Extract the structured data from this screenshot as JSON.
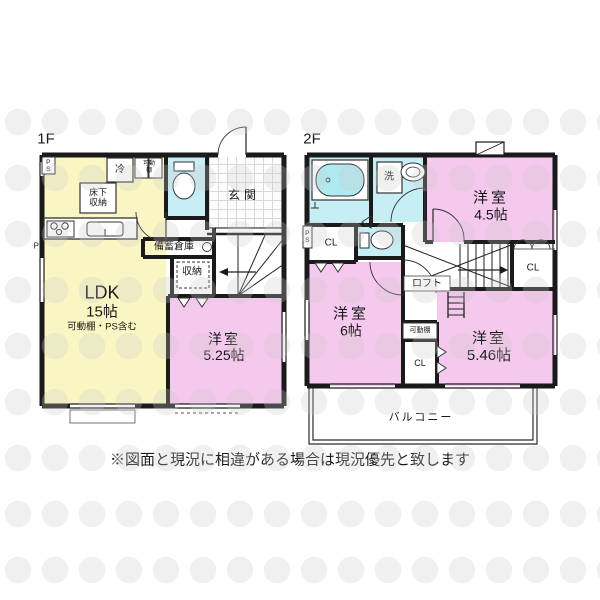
{
  "note": "※図面と現況に相違がある場合は現況優先と致します",
  "colors": {
    "wall": "#1a1a1a",
    "ldk_yellow": "#faf6c3",
    "room_pink": "#f5c8ee",
    "wet_cyan": "#c6eef4",
    "tub_cyan": "#aeeaf0"
  },
  "floor1": {
    "label": "1F",
    "ldk": {
      "name": "LDK",
      "size": "15帖",
      "sub": "可動棚・PS含む"
    },
    "western_room": {
      "name": "洋室",
      "size": "5.25帖"
    },
    "entrance": "玄関",
    "underfloor_storage": "床下収納",
    "fridge": "冷",
    "movable_shelf": "可動棚",
    "stock_storage": "備蓄倉庫",
    "storage": "収納",
    "ps_top": "PS",
    "ps_side": "PS"
  },
  "floor2": {
    "label": "2F",
    "western_room_45": {
      "name": "洋室",
      "size": "4.5帖"
    },
    "western_room_6": {
      "name": "洋室",
      "size": "6帖"
    },
    "western_room_546": {
      "name": "洋室",
      "size": "5.46帖"
    },
    "laundry": "洗",
    "closet_left": "CL",
    "closet_right": "CL",
    "closet_mid": "CL",
    "loft": "ロフト",
    "movable_shelf": "可動棚",
    "balcony": "バルコニー",
    "ps": "PS"
  }
}
